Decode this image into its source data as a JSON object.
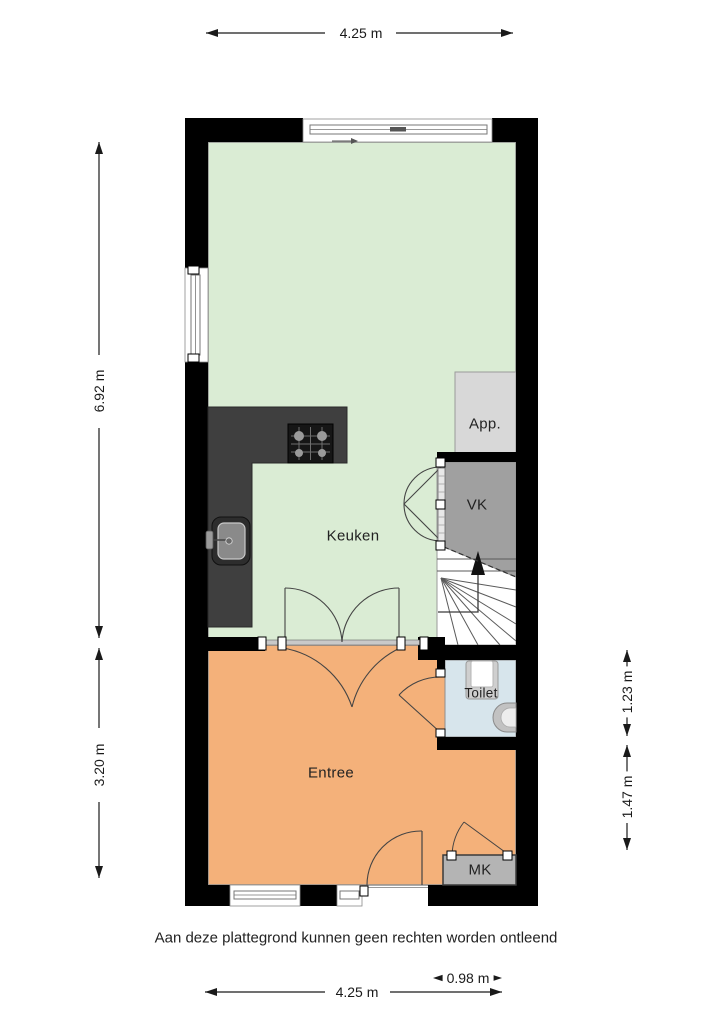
{
  "rooms": {
    "keuken": {
      "label": "Keuken",
      "color": "#daecd4"
    },
    "entree": {
      "label": "Entree",
      "color": "#f4b17a"
    },
    "toilet": {
      "label": "Toilet",
      "color": "#d7e5ec"
    },
    "vk": {
      "label": "VK",
      "color": "#a0a0a0"
    },
    "app": {
      "label": "App.",
      "color": "#d8d8d8"
    },
    "mk": {
      "label": "MK",
      "color": "#b4b4b4"
    }
  },
  "dimensions": {
    "top_width": "4.25 m",
    "left_upper": "6.92 m",
    "left_lower": "3.20 m",
    "right_upper": "1.23 m",
    "right_lower": "1.47 m",
    "bottom_right": "0.98 m",
    "bottom_width": "4.25 m"
  },
  "disclaimer": "Aan deze plattegrond kunnen geen rechten worden ontleend",
  "colors": {
    "wall": "#000000",
    "counter": "#3f3f3f",
    "cooktop": "#161616",
    "room_border": "#8f8f8f",
    "dimension_line": "#1a1a1a",
    "stair_line": "#5a5a5a"
  }
}
